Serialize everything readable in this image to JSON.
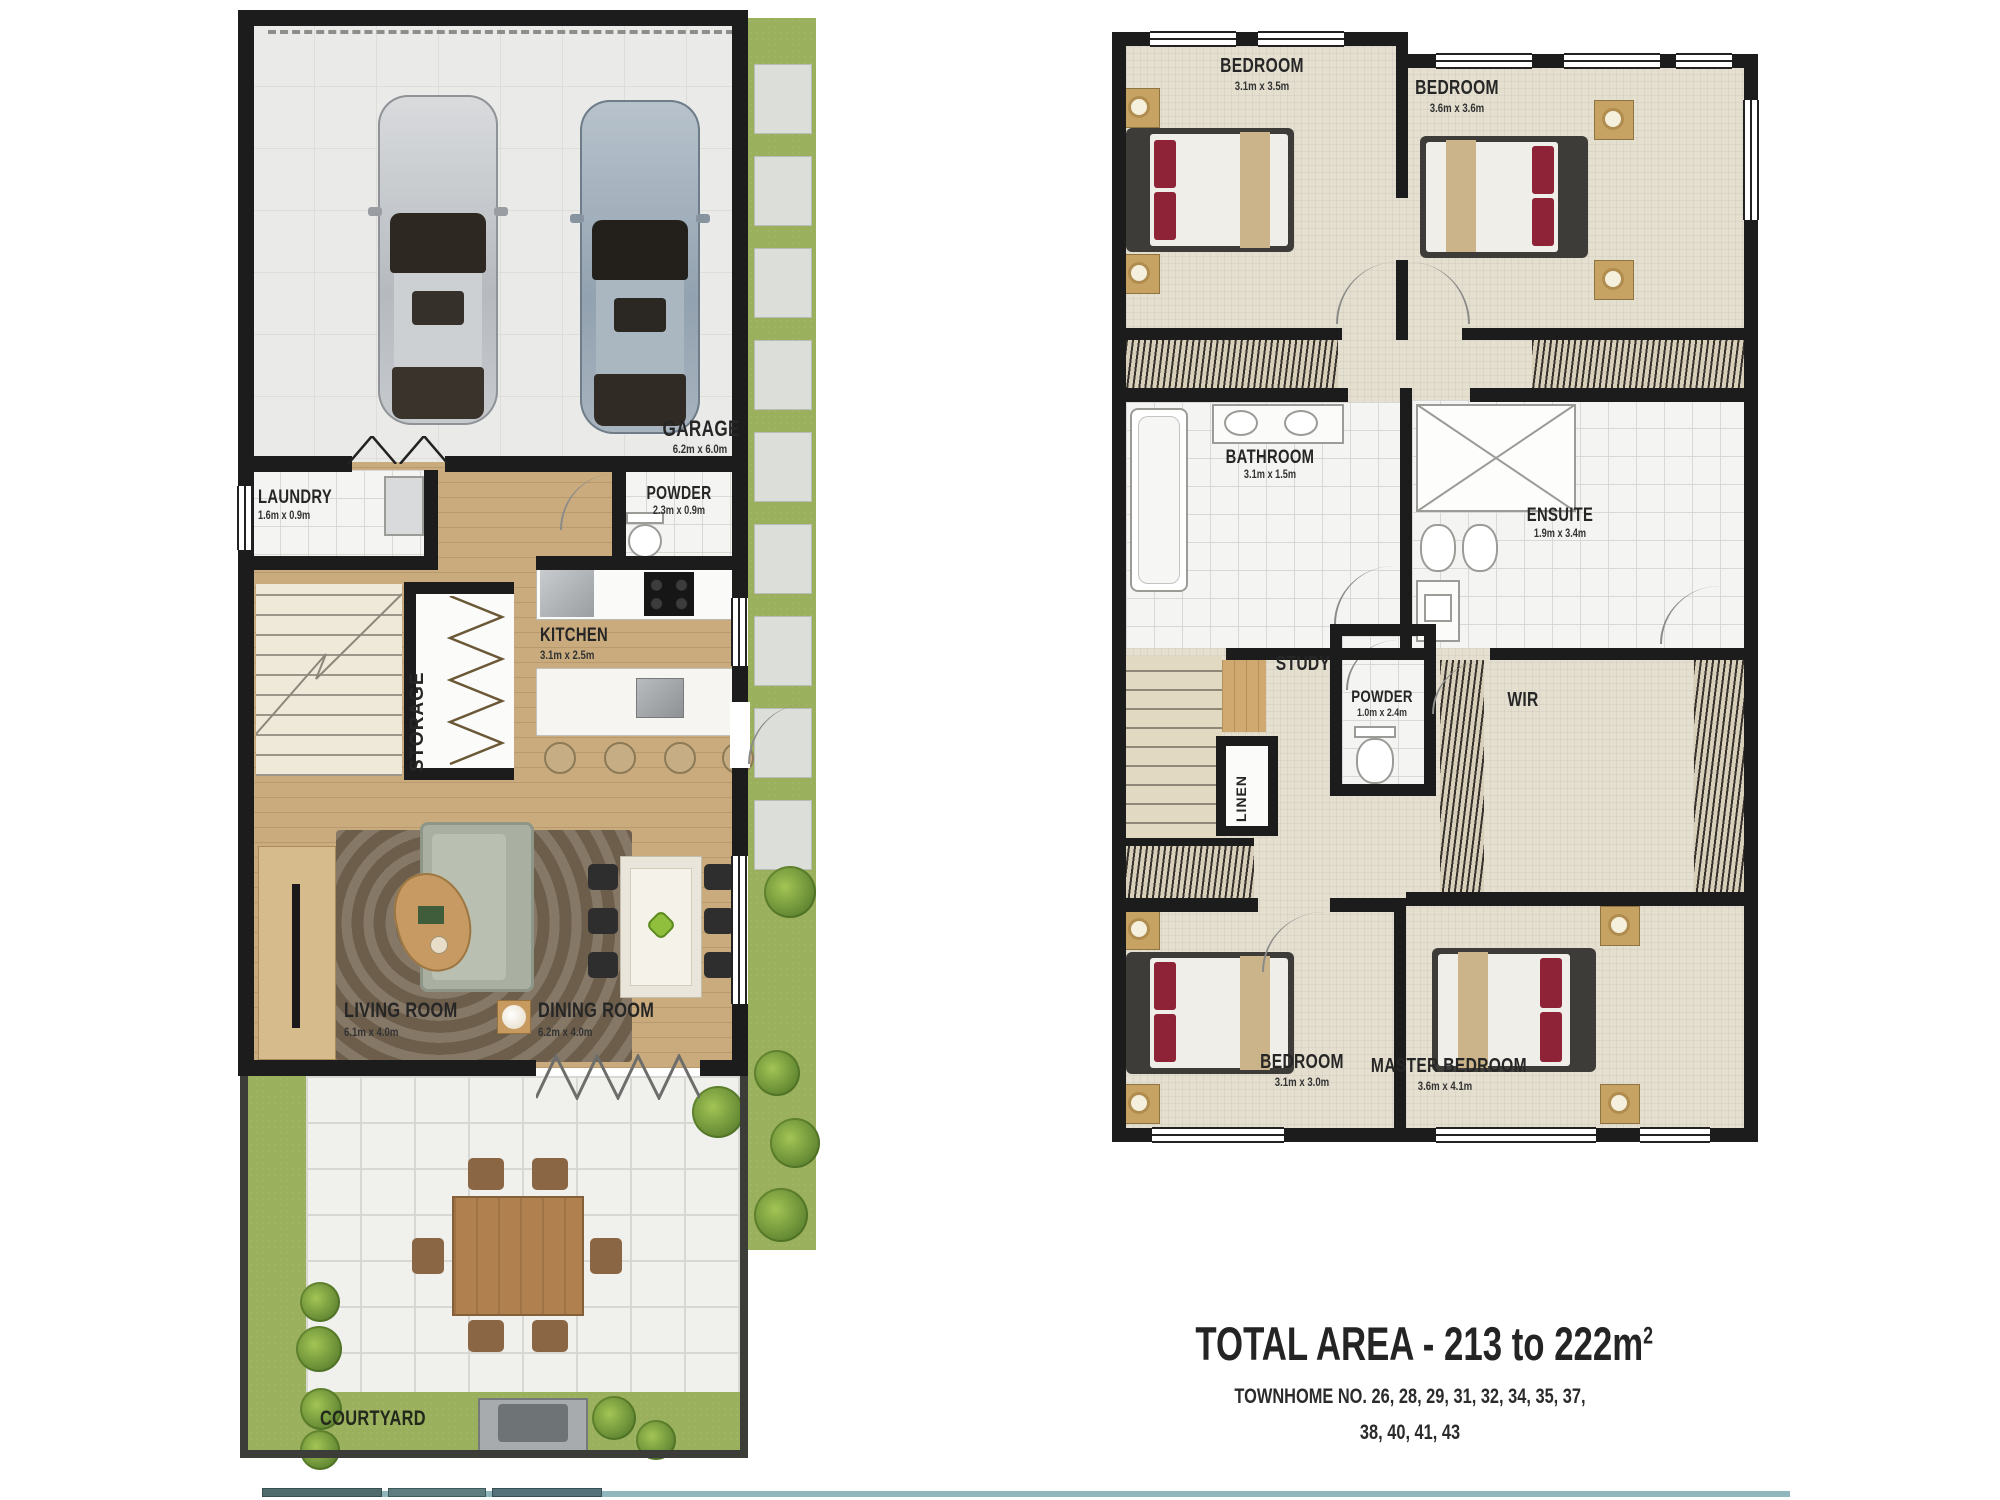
{
  "ground": {
    "garage": {
      "label": "GARAGE",
      "dims": "6.2m x 6.0m"
    },
    "laundry": {
      "label": "LAUNDRY",
      "dims": "1.6m x 0.9m"
    },
    "powder": {
      "label": "POWDER",
      "dims": "2.3m x 0.9m"
    },
    "kitchen": {
      "label": "KITCHEN",
      "dims": "3.1m x 2.5m"
    },
    "storage": {
      "label": "STORAGE"
    },
    "living": {
      "label": "LIVING ROOM",
      "dims": "6.1m x 4.0m"
    },
    "dining": {
      "label": "DINING ROOM",
      "dims": "6.2m x 4.0m"
    },
    "courtyard": {
      "label": "COURTYARD"
    }
  },
  "upper": {
    "bedroom_tl": {
      "label": "BEDROOM",
      "dims": "3.1m x 3.5m"
    },
    "bedroom_tr": {
      "label": "BEDROOM",
      "dims": "3.6m x 3.6m"
    },
    "bathroom": {
      "label": "BATHROOM",
      "dims": "3.1m x 1.5m"
    },
    "ensuite": {
      "label": "ENSUITE",
      "dims": "1.9m x 3.4m"
    },
    "study": {
      "label": "STUDY"
    },
    "powder": {
      "label": "POWDER",
      "dims": "1.0m x 2.4m"
    },
    "wir": {
      "label": "WIR"
    },
    "linen": {
      "label": "LINEN"
    },
    "bedroom_bl": {
      "label": "BEDROOM",
      "dims": "3.1m x 3.0m"
    },
    "master": {
      "label": "MASTER BEDROOM",
      "dims": "3.6m x 4.1m"
    }
  },
  "title": {
    "total_area": "TOTAL AREA - 213 to 222m",
    "total_area_sup": "2",
    "townhomes_line1": "TOWNHOME NO. 26, 28, 29, 31, 32, 34, 35, 37,",
    "townhomes_line2": "38, 40, 41, 43"
  },
  "colors": {
    "wall": "#1c1c1c",
    "grass": "#9ab05c",
    "wood": "#c9ab7e",
    "carpet": "#e4dfcf",
    "pillow_red": "#8e2337",
    "accent_strip": "#7fa9b2"
  }
}
